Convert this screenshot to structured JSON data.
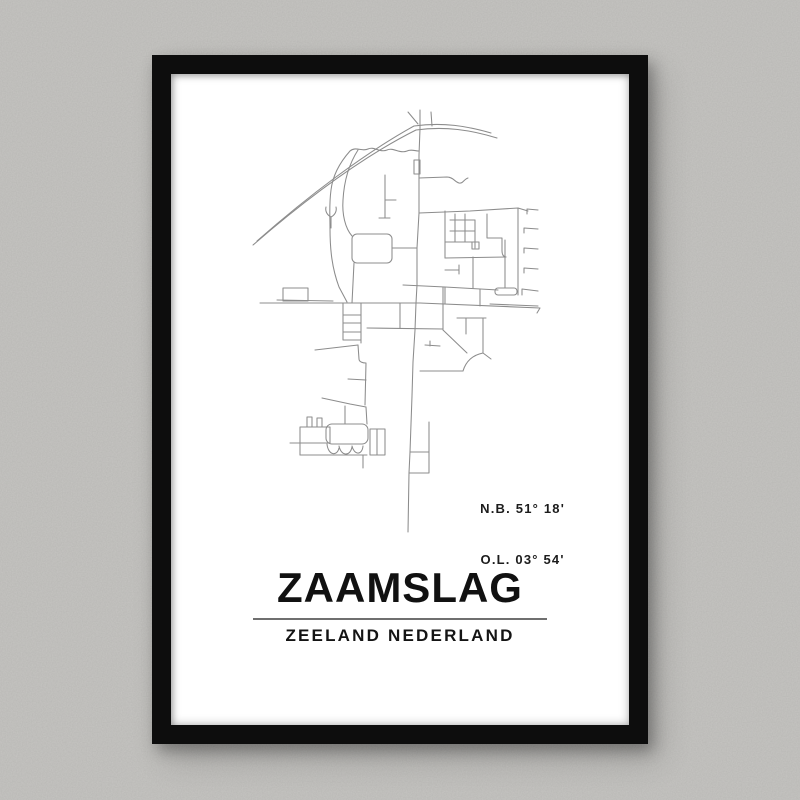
{
  "poster": {
    "title": "ZAAMSLAG",
    "subtitle": "ZEELAND NEDERLAND",
    "coordinates": {
      "latitude": "N.B. 51° 18'",
      "longitude": "O.L. 03° 54'"
    }
  },
  "colors": {
    "wall": "#c6c5c2",
    "frame": "#0d0d0d",
    "poster": "#ffffff",
    "map_line": "#8c8c8c",
    "text": "#141414",
    "divider": "#6f6f6f"
  },
  "map": {
    "name": "zaamslag-street-map",
    "viewbox": "250 100 320 445",
    "stroke_width": 1.05,
    "paths": [
      "M253,245 C305,200 362,157 416,130 C445,126 471,130 497,138",
      "M257,241 C308,196 365,153 414,126 C443,122 467,126 491,133",
      "M408,112 L418,124",
      "M431,112 L432,126",
      "M420,110 L420,129 L419,155 L419,213 L417,248 L417,285 L416,303 L415,330 L413,362 L412,396 L410,452 L409,473 L408,532",
      "M414,160 h6 v14 h-6 z",
      "M350,151 C356,146 362,152 368,149 C374,146 380,153 387,150 C393,147 400,154 407,151 C411,149 415,151 419,151",
      "M419,178 L447,177 C453,177 455,182 459,183 C463,184 464,179 468,178",
      "M350,151 C342,160 333,173 331,190 C329,205 330,216 330,228 C330,250 332,268 339,287 L347,302",
      "M331,228 L331,217 M331,217 C327,215 325,211 326,207 M331,217 C335,215 337,211 336,207",
      "M358,150 C349,164 344,182 343,200 C342,214 345,228 352,236",
      "M354,263 L352,303",
      "M357,234 L387,234 A5,5 0 0 1 392,239 L392,258 A5,5 0 0 1 387,263 L357,263 A5,5 0 0 1 352,258 L352,239 A5,5 0 0 1 357,234 Z",
      "M392,248 L417,248",
      "M385,175 L385,218 M385,200 L396,200 M379,218 L390,218",
      "M419,213 L470,211 L518,208 L528,211",
      "M518,208 L518,295",
      "M527,214 L527,209 L538,210",
      "M524,233 L524,228 L538,229",
      "M524,253 L524,248 L538,249",
      "M524,273 L524,268 L538,269",
      "M522,295 L522,289 L538,291",
      "M445,211 L445,258",
      "M455,214 L455,242",
      "M465,214 L465,242",
      "M450,220 L475,220",
      "M450,231 L475,231",
      "M445,242 L475,242",
      "M472,242 h7 v7 h-7 z",
      "M475,220 L475,248",
      "M487,214 L487,238 L502,238 L502,251 C502,255 504,257 506,257",
      "M445,258 L506,257",
      "M445,270 L459,270 M459,265 L459,274",
      "M505,240 L505,288",
      "M498,288 h16 a3,3 0 0 1 3,3 v1 a3,3 0 0 1 -3,3 h-16 a3,3 0 0 1 -3,-3 v-1 a3,3 0 0 1 3,-3 z",
      "M403,285 L445,287 L498,290",
      "M445,287 L445,304",
      "M480,289 L480,306",
      "M473,257 L473,288",
      "M260,303 L420,303 L540,308 L537,313",
      "M277,300 L333,301",
      "M490,304 L538,306",
      "M283,288 h25 v13 h-25 z",
      "M343,303 L343,340 M361,303 L361,343 M343,315 L361,315 M343,323 L361,323 M343,332 L361,332 M343,340 L361,340",
      "M367,328 L443,329",
      "M400,303 L400,328",
      "M443,287 L443,330",
      "M443,330 L467,353",
      "M463,371 C466,361 473,355 483,353",
      "M483,318 L483,353 M483,353 L491,359",
      "M420,371 L463,371",
      "M457,318 L486,318 M466,318 L466,334",
      "M425,345 L440,346 M430,341 L430,346",
      "M315,350 L358,345",
      "M358,345 L359,359 C359,362 363,363 366,363 L365,405",
      "M348,379 L366,380",
      "M322,398 L350,404 L366,407",
      "M345,406 L345,424",
      "M366,407 L367,424",
      "M332,424 L362,424 A6,6 0 0 1 368,430 L368,438 A6,6 0 0 1 362,444 L332,444 A6,6 0 0 1 326,438 L326,430 A6,6 0 0 1 332,424 Z",
      "M327,444 C328,455 337,457 339,448 M339,446 C341,456 350,457 352,447 M352,446 C354,455 362,456 363,446",
      "M300,455 L367,455",
      "M300,427 L330,427 L330,443 M300,427 L300,455 M290,443 L330,443",
      "M307,417 h5 v10 h-5 z M317,418 h5 v9 h-5 z",
      "M370,429 h15 v26 h-15 z M377,429 L377,455",
      "M410,452 L429,452 M429,422 L429,473 M409,473 L429,473",
      "M363,455 L363,468"
    ]
  }
}
